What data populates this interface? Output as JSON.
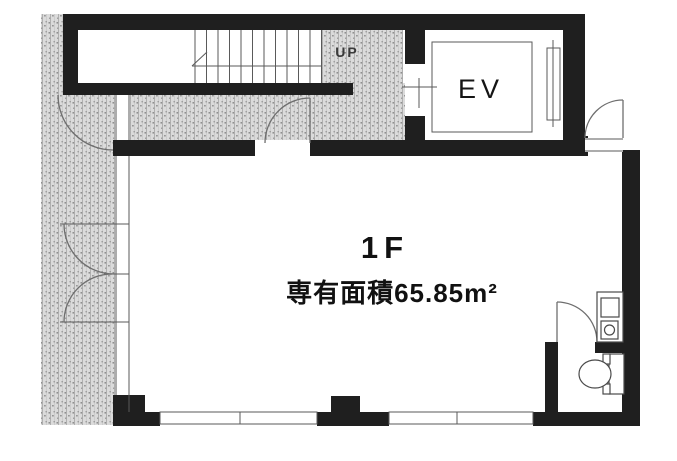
{
  "labels": {
    "stairs_direction": "UP",
    "elevator": "EV",
    "floor": "1F",
    "area": "専有面積65.85m²"
  },
  "colors": {
    "wall": "#1f1f1f",
    "hatch": "#dbdbdb",
    "line": "#5a5a5a",
    "text": "#111111"
  }
}
